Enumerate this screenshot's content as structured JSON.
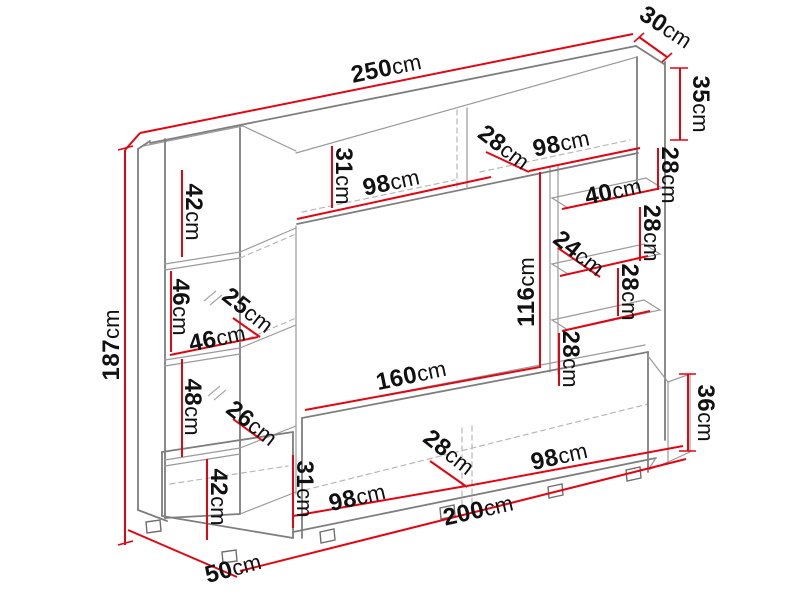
{
  "diagram": {
    "type": "furniture-dimension-drawing",
    "subject": "wall-unit-entertainment-center",
    "unit": "cm",
    "colors": {
      "dimension_line": "#e20613",
      "outline": "#7e7e7e",
      "outline_light": "#9a9a9a",
      "dashed": "#b8b8b8",
      "label_text": "#111111",
      "background": "#ffffff"
    },
    "dimensions": [
      {
        "id": "width-total",
        "value": "250",
        "unit": "cm",
        "label": {
          "x": 386,
          "y": 68,
          "rot": -11.5
        },
        "line": {
          "x1": 140,
          "y1": 133,
          "x2": 633,
          "y2": 34
        }
      },
      {
        "id": "depth-top",
        "value": "30",
        "unit": "cm",
        "label": {
          "x": 666,
          "y": 27,
          "rot": 33
        },
        "line": {
          "x1": 639,
          "y1": 37,
          "x2": 667,
          "y2": 57
        },
        "ticks": [
          {
            "x1": 634,
            "y1": 42,
            "x2": 644,
            "y2": 33
          },
          {
            "x1": 662,
            "y1": 62,
            "x2": 672,
            "y2": 53
          }
        ]
      },
      {
        "id": "height-right-top-cabinet",
        "value": "35",
        "unit": "cm",
        "label": {
          "x": 701,
          "y": 104,
          "rot": 90
        },
        "line": {
          "x1": 680,
          "y1": 68,
          "x2": 680,
          "y2": 140
        },
        "ticks": [
          {
            "x1": 670,
            "y1": 68,
            "x2": 688,
            "y2": 68
          },
          {
            "x1": 670,
            "y1": 140,
            "x2": 688,
            "y2": 140
          }
        ]
      },
      {
        "id": "gap-right-1",
        "value": "28",
        "unit": "cm",
        "label": {
          "x": 670,
          "y": 175,
          "rot": 90
        },
        "line": {
          "x1": 658,
          "y1": 148,
          "x2": 658,
          "y2": 190
        }
      },
      {
        "id": "shelf-top-width",
        "value": "40",
        "unit": "cm",
        "label": {
          "x": 613,
          "y": 191,
          "rot": -12
        },
        "line": {
          "x1": 562,
          "y1": 209,
          "x2": 657,
          "y2": 189
        }
      },
      {
        "id": "gap-right-2",
        "value": "28",
        "unit": "cm",
        "label": {
          "x": 652,
          "y": 233,
          "rot": 90
        },
        "line": {
          "x1": 640,
          "y1": 207,
          "x2": 640,
          "y2": 261
        }
      },
      {
        "id": "shelf-depth",
        "value": "24",
        "unit": "cm",
        "label": {
          "x": 579,
          "y": 253,
          "rot": 38
        },
        "line": {
          "x1": 558,
          "y1": 248,
          "x2": 600,
          "y2": 277
        }
      },
      {
        "id": "gap-right-3",
        "value": "28",
        "unit": "cm",
        "label": {
          "x": 630,
          "y": 292,
          "rot": 90
        },
        "line": {
          "x1": 618,
          "y1": 268,
          "x2": 618,
          "y2": 316
        }
      },
      {
        "id": "gap-right-4",
        "value": "28",
        "unit": "cm",
        "label": {
          "x": 571,
          "y": 359,
          "rot": 90
        },
        "line": {
          "x1": 559,
          "y1": 333,
          "x2": 559,
          "y2": 386
        }
      },
      {
        "id": "tv-opening-height",
        "value": "116",
        "unit": "cm",
        "label": {
          "x": 526,
          "y": 292,
          "rot": -90
        },
        "line": {
          "x1": 540,
          "y1": 172,
          "x2": 540,
          "y2": 368
        }
      },
      {
        "id": "tv-opening-width",
        "value": "160",
        "unit": "cm",
        "label": {
          "x": 411,
          "y": 375,
          "rot": -12
        },
        "line": {
          "x1": 305,
          "y1": 410,
          "x2": 540,
          "y2": 367
        }
      },
      {
        "id": "top-cabinet-height",
        "value": "31",
        "unit": "cm",
        "label": {
          "x": 344,
          "y": 176,
          "rot": 90
        },
        "line": {
          "x1": 332,
          "y1": 146,
          "x2": 332,
          "y2": 208
        }
      },
      {
        "id": "top-cabinet-width-left",
        "value": "98",
        "unit": "cm",
        "label": {
          "x": 391,
          "y": 182,
          "rot": -12
        },
        "line": {
          "x1": 297,
          "y1": 219,
          "x2": 491,
          "y2": 177
        }
      },
      {
        "id": "top-cabinet-depth",
        "value": "28",
        "unit": "cm",
        "label": {
          "x": 504,
          "y": 147,
          "rot": 37
        },
        "line": {
          "x1": 486,
          "y1": 152,
          "x2": 529,
          "y2": 172
        }
      },
      {
        "id": "top-cabinet-width-right",
        "value": "98",
        "unit": "cm",
        "label": {
          "x": 561,
          "y": 143,
          "rot": -12
        },
        "line": {
          "x1": 529,
          "y1": 171,
          "x2": 640,
          "y2": 148
        }
      },
      {
        "id": "left-upper-cabinet-height",
        "value": "42",
        "unit": "cm",
        "label": {
          "x": 194,
          "y": 212,
          "rot": 90
        },
        "line": {
          "x1": 182,
          "y1": 170,
          "x2": 182,
          "y2": 257
        }
      },
      {
        "id": "left-glass-section-height",
        "value": "46",
        "unit": "cm",
        "label": {
          "x": 181,
          "y": 307,
          "rot": 90
        },
        "line": {
          "x1": 171,
          "y1": 271,
          "x2": 171,
          "y2": 352
        }
      },
      {
        "id": "left-column-depth",
        "value": "25",
        "unit": "cm",
        "label": {
          "x": 248,
          "y": 310,
          "rot": 38
        },
        "line": {
          "x1": 233,
          "y1": 318,
          "x2": 260,
          "y2": 337
        }
      },
      {
        "id": "left-column-inner-width",
        "value": "46",
        "unit": "cm",
        "label": {
          "x": 217,
          "y": 338,
          "rot": -12
        },
        "line": {
          "x1": 170,
          "y1": 355,
          "x2": 258,
          "y2": 337
        }
      },
      {
        "id": "height-total",
        "value": "187",
        "unit": "cm",
        "label": {
          "x": 111,
          "y": 345,
          "rot": -90
        },
        "line": {
          "x1": 125,
          "y1": 150,
          "x2": 125,
          "y2": 545
        },
        "ticks": [
          {
            "x1": 118,
            "y1": 150,
            "x2": 133,
            "y2": 146
          },
          {
            "x1": 118,
            "y1": 545,
            "x2": 133,
            "y2": 541
          }
        ]
      },
      {
        "id": "left-lower-section-height",
        "value": "48",
        "unit": "cm",
        "label": {
          "x": 193,
          "y": 407,
          "rot": 90
        },
        "line": {
          "x1": 182,
          "y1": 359,
          "x2": 182,
          "y2": 457
        }
      },
      {
        "id": "left-lower-depth",
        "value": "26",
        "unit": "cm",
        "label": {
          "x": 252,
          "y": 423,
          "rot": 38
        },
        "line": {
          "x1": 233,
          "y1": 419,
          "x2": 263,
          "y2": 441
        }
      },
      {
        "id": "stand-end-height",
        "value": "36",
        "unit": "cm",
        "label": {
          "x": 706,
          "y": 413,
          "rot": 90
        },
        "line": {
          "x1": 688,
          "y1": 374,
          "x2": 688,
          "y2": 451
        },
        "ticks": [
          {
            "x1": 679,
            "y1": 374,
            "x2": 696,
            "y2": 374
          },
          {
            "x1": 679,
            "y1": 451,
            "x2": 696,
            "y2": 451
          }
        ]
      },
      {
        "id": "left-bottom-cabinet-height",
        "value": "42",
        "unit": "cm",
        "label": {
          "x": 219,
          "y": 497,
          "rot": 90
        },
        "line": {
          "x1": 207,
          "y1": 459,
          "x2": 207,
          "y2": 540
        }
      },
      {
        "id": "stand-front-height",
        "value": "31",
        "unit": "cm",
        "label": {
          "x": 305,
          "y": 489,
          "rot": 90
        },
        "line": {
          "x1": 293,
          "y1": 455,
          "x2": 293,
          "y2": 528
        }
      },
      {
        "id": "stand-section-width-left",
        "value": "98",
        "unit": "cm",
        "label": {
          "x": 357,
          "y": 497,
          "rot": -13
        },
        "line": {
          "x1": 293,
          "y1": 516,
          "x2": 466,
          "y2": 486
        }
      },
      {
        "id": "stand-depth",
        "value": "28",
        "unit": "cm",
        "label": {
          "x": 449,
          "y": 452,
          "rot": 38
        },
        "line": {
          "x1": 430,
          "y1": 461,
          "x2": 467,
          "y2": 487
        }
      },
      {
        "id": "stand-section-width-right",
        "value": "98",
        "unit": "cm",
        "label": {
          "x": 559,
          "y": 456,
          "rot": -13
        },
        "line": {
          "x1": 467,
          "y1": 486,
          "x2": 683,
          "y2": 446
        }
      },
      {
        "id": "stand-width-total",
        "value": "200",
        "unit": "cm",
        "label": {
          "x": 478,
          "y": 510,
          "rot": -13
        },
        "line": {
          "x1": 240,
          "y1": 571,
          "x2": 686,
          "y2": 459
        }
      },
      {
        "id": "base-depth",
        "value": "50",
        "unit": "cm",
        "label": {
          "x": 233,
          "y": 568,
          "rot": -15
        },
        "line": {
          "x1": 128,
          "y1": 530,
          "x2": 237,
          "y2": 577
        }
      }
    ],
    "accent_edges": [
      {
        "x1": 140,
        "y1": 133,
        "x2": 125,
        "y2": 150
      },
      {
        "x1": 560,
        "y1": 276,
        "x2": 648,
        "y2": 256
      },
      {
        "x1": 562,
        "y1": 331,
        "x2": 650,
        "y2": 311
      }
    ]
  }
}
